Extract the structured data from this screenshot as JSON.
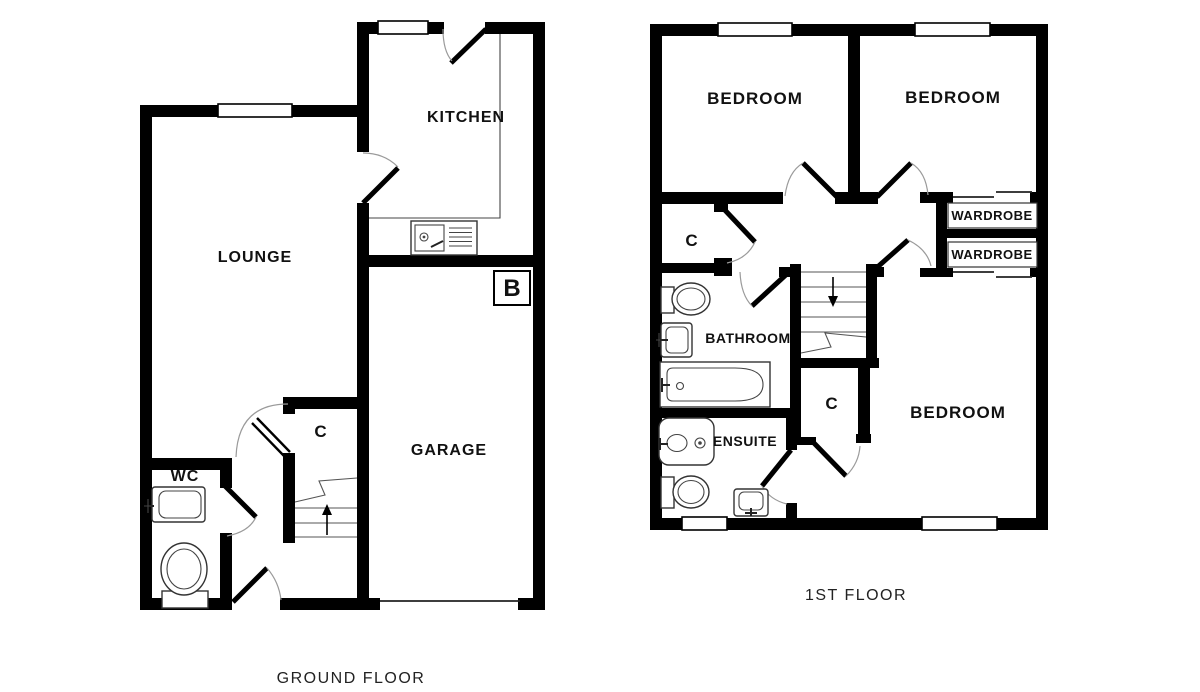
{
  "meta": {
    "background": "#ffffff",
    "wall_color": "#000000",
    "arc_color": "#9a9a9a"
  },
  "ground_floor": {
    "title": "GROUND FLOOR",
    "rooms": {
      "kitchen": "KITCHEN",
      "lounge": "LOUNGE",
      "garage": "GARAGE",
      "wc": "WC",
      "cupboard": "C",
      "boiler": "B"
    }
  },
  "first_floor": {
    "title": "1ST FLOOR",
    "rooms": {
      "bedroom_left": "BEDROOM",
      "bedroom_right": "BEDROOM",
      "bedroom_main": "BEDROOM",
      "wardrobe_top": "WARDROBE",
      "wardrobe_bottom": "WARDROBE",
      "bathroom": "BATHROOM",
      "ensuite": "ENSUITE",
      "cupboard": "C"
    }
  }
}
